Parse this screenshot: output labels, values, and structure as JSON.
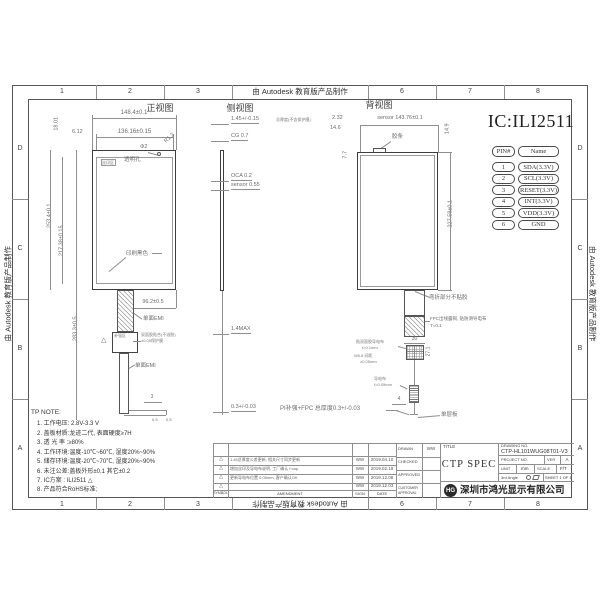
{
  "frame": {
    "edu_notice": "由 Autodesk 教育版产品制作",
    "cols": [
      "1",
      "2",
      "3",
      "6",
      "7",
      "8"
    ],
    "rows": [
      "D",
      "C",
      "B",
      "A"
    ]
  },
  "front": {
    "title": "正视图",
    "dim_w_outer": "148.4±0.1",
    "dim_w_inner": "136.16±0.15",
    "dim_margin_left": "6.12",
    "dim_top": "18.01",
    "dim_h_outer": "253.4±0.1",
    "dim_h_inner": "217.38±0.15",
    "dim_h_total": "283.3±0.5",
    "corner_radius": "R1.2",
    "hole_dia": "Φ2",
    "hole_label": "透明孔",
    "ink_box": "丝印区",
    "print_black": "印刷黑色",
    "dim_fpc_offset": "96.2±0.5",
    "emi_upper": "单面EMI",
    "emi_lower": "单面EMI",
    "stiffener_box": "补强区",
    "rev_triangle": "△",
    "stiffener_note1": "双面胶贴合(不溢胶)",
    "stiffener_note2": "±0.05保护膜",
    "dim_foot": "3",
    "dim_foot_a": "0.5",
    "dim_foot_b": "0.5"
  },
  "side": {
    "title": "侧视图",
    "total": "1.45+/-0.15",
    "total_note": "总厚度(不含保护膜)",
    "cg": "CG 0.7",
    "oca": "OCA 0.2",
    "sensor": "sensor 0.55",
    "fpc_max": "1.4MAX",
    "fpc_thk": "0.3+/-0.03",
    "stiffener_total": "PI补强+FPC 总厚度0.3+/-0.03"
  },
  "back": {
    "title": "背视图",
    "dim_a": "2.32",
    "dim_b": "14.6",
    "dim_sensor_w": "sensor 143.76±0.1",
    "dim_c": "7.7",
    "dim_d": "14.9",
    "dim_h": "227.58±0.1",
    "notch_label": "胶条",
    "bend_label": "弯折部分不贴胶",
    "copper_label": "FPC出线露铜, 贴防滑导电布",
    "copper_thk": "T=0.1",
    "dim_cloth_w": "30",
    "cloth_note1": "贴双面胶导电布",
    "cloth_note2": "t=0.1mm",
    "cloth_note3": "W0.8 间距",
    "cloth_note4": "±0.05mm",
    "dim_cloth_h": "27.1",
    "cond_label": "导电布",
    "cond_thk": "t=0.05mm",
    "dim_e": "4",
    "single_layer": "单层板"
  },
  "ic_label": "IC:ILI2511",
  "pin_table": {
    "h_pin": "PIN#",
    "h_name": "Name",
    "rows": [
      [
        "1",
        "SDA(3.3V)"
      ],
      [
        "2",
        "SCL(3.3V)"
      ],
      [
        "3",
        "RESET(3.3V)"
      ],
      [
        "4",
        "INT(3.3V)"
      ],
      [
        "5",
        "VDD(3.3V)"
      ],
      [
        "6",
        "GND"
      ]
    ]
  },
  "tp_note": {
    "title": "TP NOTE:",
    "lines": [
      "1.  工作电压: 2.8V-3.3 V",
      "2.  盖板材质:龙迹二代, 表面硬度≥7H",
      "3.  透 光 率 :≥80%",
      "4.  工作环境:温度-10℃~60℃, 湿度20%~90%",
      "5.  储存环境:温度-20℃~70℃, 湿度20%~90%",
      "6.  未注公差:盖板外形±0.1  其它±0.2",
      "7.  IC方案   :  ILI2511 △",
      "8.  产品符合RoHS标准;"
    ]
  },
  "amendment": {
    "h_symbol": "SYMBOL",
    "h_amendment": "AMENDMENT",
    "h_sign": "SIGN",
    "h_date": "DATE",
    "rows": [
      {
        "sym": "△",
        "text": "1.45总厚度公差更新, 相关尺寸同步更新",
        "sign": "WW",
        "date": "2019.04.10"
      },
      {
        "sym": "△",
        "text": "增加丝印及导电布说明, 工厂确认 f cap",
        "sign": "WW",
        "date": "2019.02.19"
      },
      {
        "sym": "△",
        "text": "更新导电布位置 0.05mm, 客户确认OK",
        "sign": "WW",
        "date": "2019.12.08"
      },
      {
        "sym": "△",
        "text": "",
        "sign": "WW",
        "date": "2019.12.03"
      }
    ]
  },
  "title_block": {
    "drawn_label": "DRAWN",
    "drawn": "WW",
    "checked_label": "CHECKED",
    "approved_label": "APPROVED",
    "customer_label": "CUSTOMER APPROVAL",
    "title_label": "TITLE",
    "title": "CTP SPEC",
    "drawing_no_label": "DRAWING NO.",
    "drawing_no": "CTP-HL101WUG08T01-V3",
    "project_no_label": "PROJECT NO.",
    "ver_label": "VER",
    "ver": "A",
    "unit_label": "UNIT",
    "unit": "mm",
    "scale_label": "SCALE",
    "scale": "F/T",
    "angle_label": "3rd Angle",
    "sheet": "SHEET 1 OF 1",
    "company_logo_text": "HG",
    "company": "深圳市鸿光显示有限公司"
  }
}
